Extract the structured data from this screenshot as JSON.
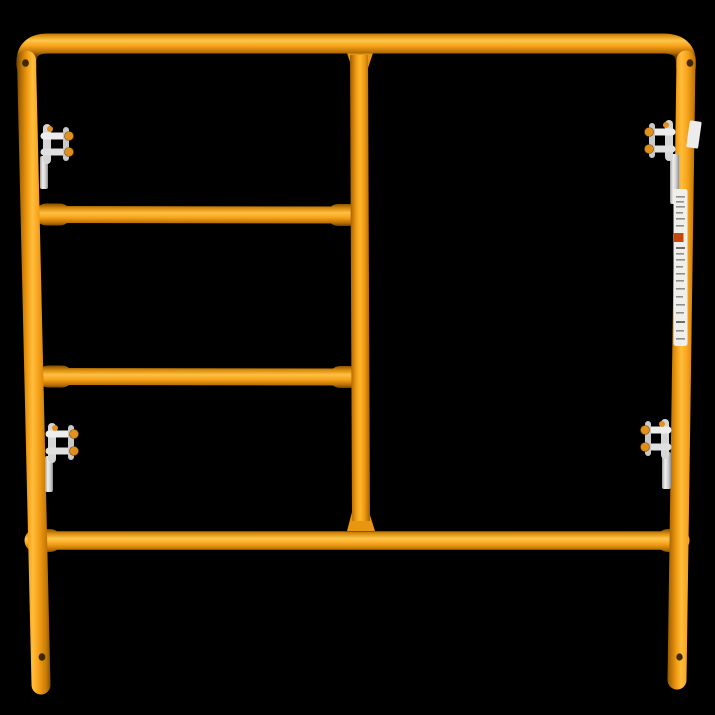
{
  "scene": {
    "subject": "Orange steel walk-through scaffolding ladder frame with drop-lock clips",
    "background_color": "#000000"
  },
  "frame": {
    "tube_color_main": "#F8A21B",
    "tube_color_highlight": "#FFC64B",
    "tube_color_midshadow": "#C27805",
    "tube_color_edge": "#6E4100",
    "parts": {
      "top_rail": "top-rail",
      "left_post": "left-post",
      "right_post": "right-post",
      "center_post": "center-post",
      "upper_rung": "upper-rung",
      "lower_rung": "lower-rung",
      "bottom_rail": "bottom-rail",
      "left_leg": "left-leg-extension",
      "right_leg": "right-leg-extension"
    },
    "rivet_hole_color": "#3F2800",
    "rivet_holes": [
      {
        "id": "rivet-hole-top-left"
      },
      {
        "id": "rivet-hole-top-right"
      },
      {
        "id": "rivet-hole-bottom-left"
      },
      {
        "id": "rivet-hole-bottom-right"
      }
    ]
  },
  "hardware": {
    "clip_metal_color": "#E2E2E2",
    "clip_shade_color": "#A8A8A8",
    "pin_color": "#E09120",
    "clips": [
      {
        "id": "drop-lock-upper-left"
      },
      {
        "id": "drop-lock-upper-right"
      },
      {
        "id": "drop-lock-lower-left"
      },
      {
        "id": "drop-lock-lower-right"
      }
    ]
  },
  "stickers": {
    "label_background": "#F0EFE9",
    "label_accent": "#C4490C",
    "label_textline_color": "#8F8F8F",
    "items": [
      {
        "id": "wrap-sticker-top-right-post"
      },
      {
        "id": "spec-label-right-post"
      }
    ]
  }
}
